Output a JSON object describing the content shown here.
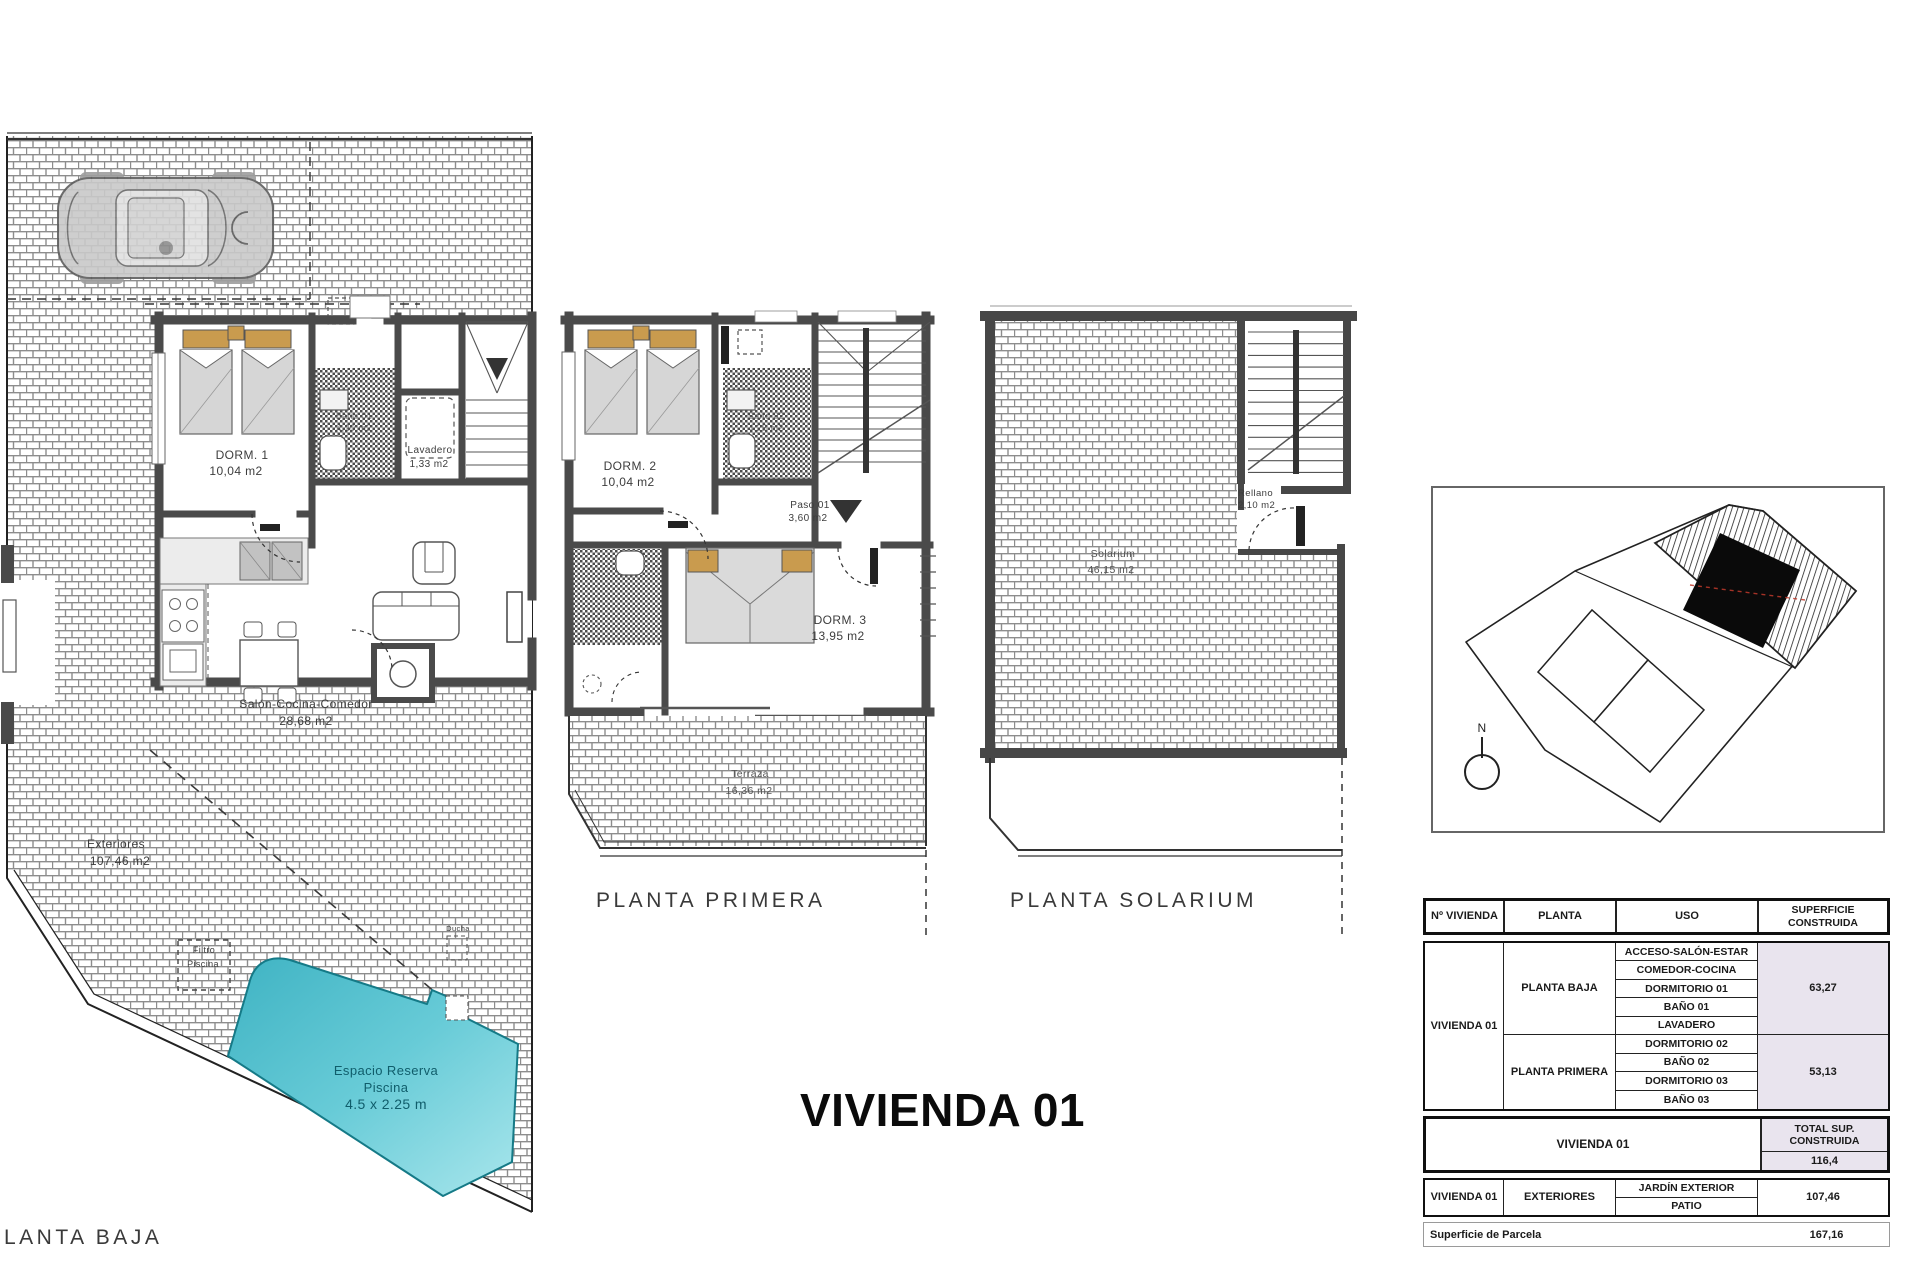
{
  "page": {
    "background": "#ffffff"
  },
  "main_title": {
    "text": "VIVIENDA 01"
  },
  "colors": {
    "pool": "#45b6c6",
    "table_shading": "#e9e4ee",
    "wall": "#4a4a4a"
  },
  "plans": {
    "planta_baja": {
      "title": "LANTA BAJA",
      "labels": {
        "dorm1_name": "DORM. 1",
        "dorm1_area": "10,04 m2",
        "bano1_name": "Baño 01",
        "bano1_area": "4,20 m2",
        "lavadero_name": "Lavadero",
        "lavadero_area": "1,33 m2",
        "salon_name": "Salón-Cocina-Comedor",
        "salon_area": "28,68 m2",
        "exteriores_name": "Exteriores",
        "exteriores_area": "107,46 m2",
        "filtro_line1": "Filtro",
        "filtro_line2": "Piscina",
        "ducha": "Ducha",
        "piscina_line1": "Espacio Reserva",
        "piscina_line2": "Piscina",
        "piscina_line3": "4.5 x 2.25 m"
      }
    },
    "planta_primera": {
      "title": "PLANTA PRIMERA",
      "labels": {
        "dorm2_name": "DORM. 2",
        "dorm2_area": "10,04 m2",
        "bano2_name": "Baño 02",
        "bano2_area": "4,25 m2",
        "paso_name": "Paso 01",
        "paso_area": "3,60 m2",
        "dorm3_name": "DORM. 3",
        "dorm3_area": "13,95 m2",
        "terraza_name": "Terraza",
        "terraza_area": "16,36 m2"
      }
    },
    "planta_solarium": {
      "title": "PLANTA SOLARIUM",
      "labels": {
        "solarium_name": "Solarium",
        "solarium_area": "46,15 m2",
        "rellano_name": "Rellano",
        "rellano_area": "2,10 m2"
      }
    }
  },
  "site_plan": {
    "compass": "N"
  },
  "table": {
    "header": {
      "col1": "Nº VIVIENDA",
      "col2": "PLANTA",
      "col3": "USO",
      "col4": "SUPERFICIE CONSTRUIDA"
    },
    "vivienda_label": "VIVIENDA 01",
    "planta_baja": {
      "label": "PLANTA BAJA",
      "usos": [
        "ACCESO-SALÓN-ESTAR",
        "COMEDOR-COCINA",
        "DORMITORIO 01",
        "BAÑO 01",
        "LAVADERO"
      ],
      "superficie": "63,27"
    },
    "planta_primera": {
      "label": "PLANTA PRIMERA",
      "usos": [
        "DORMITORIO 02",
        "BAÑO 02",
        "DORMITORIO 03",
        "BAÑO 03"
      ],
      "superficie": "53,13"
    },
    "total": {
      "label": "VIVIENDA 01",
      "header_line1": "TOTAL SUP.",
      "header_line2": "CONSTRUIDA",
      "value": "116,4"
    },
    "exteriores": {
      "vivienda": "VIVIENDA 01",
      "planta": "EXTERIORES",
      "uso1": "JARDÍN EXTERIOR",
      "uso2": "PATIO",
      "superficie": "107,46"
    },
    "parcela": {
      "label": "Superficie de Parcela",
      "value": "167,16"
    }
  }
}
